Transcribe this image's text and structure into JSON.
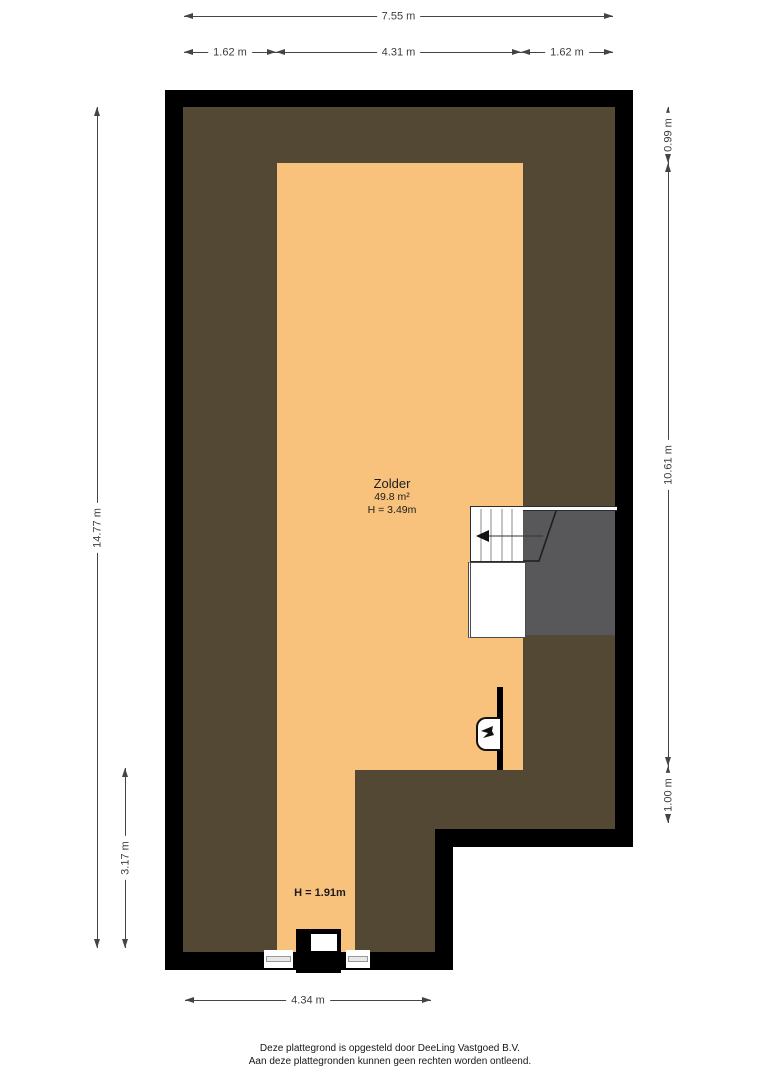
{
  "room": {
    "name": "Zolder",
    "area": "49.8 m²",
    "ceiling_height": "H = 3.49m"
  },
  "annotations": {
    "low_ceiling_height": "H = 1.91m"
  },
  "dimensions": {
    "top_total": "7.55 m",
    "top_left": "1.62 m",
    "top_center": "4.31 m",
    "top_right": "1.62 m",
    "left_total": "14.77 m",
    "left_lower": "3.17 m",
    "right_upper": "0.99 m",
    "right_middle": "10.61 m",
    "right_lower": "1.00 m",
    "bottom": "4.34 m"
  },
  "footer": {
    "line1": "Deze plattegrond is opgesteld door DeeLing Vastgoed B.V.",
    "line2": "Aan deze plattegronden kunnen geen rechten worden ontleend."
  },
  "icons": {
    "stairs_direction": "left-arrow-icon",
    "fixture": "water-tap-icon"
  },
  "colors": {
    "wall": "#000000",
    "attic": "#524833",
    "room": "#f8c27c",
    "stairwell": "#58585a",
    "dim": "#3d3d3d",
    "line": "#444444"
  }
}
